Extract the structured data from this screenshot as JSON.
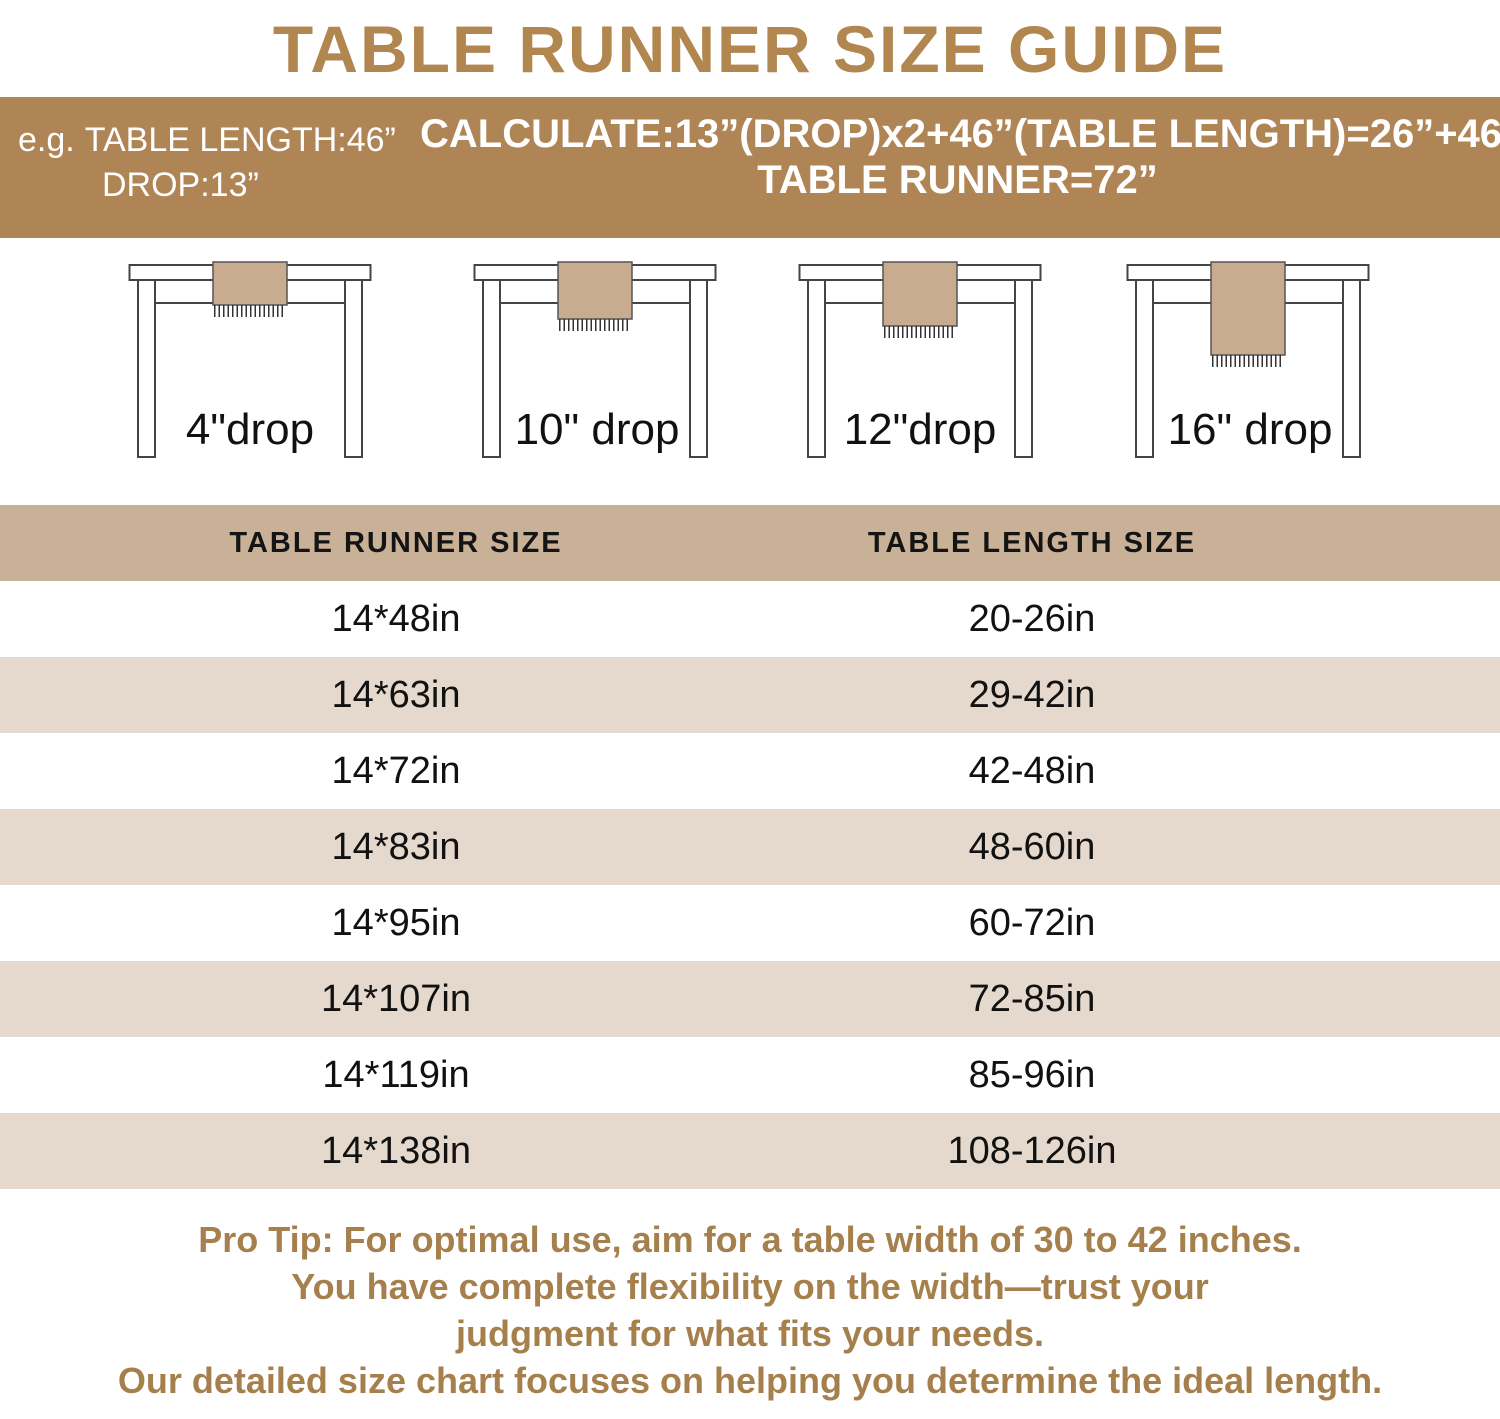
{
  "title": "TABLE RUNNER SIZE GUIDE",
  "banner": {
    "example_prefix": "e.g.",
    "example_line1": "TABLE LENGTH:46”",
    "example_line2": "DROP:13”",
    "calc_line1": "CALCULATE:13”(DROP)x2+46”(TABLE LENGTH)=26”+46”",
    "calc_line2": "TABLE RUNNER=72”"
  },
  "diagrams": [
    {
      "label": "4\"drop"
    },
    {
      "label": "10\" drop"
    },
    {
      "label": "12\"drop"
    },
    {
      "label": "16\" drop"
    }
  ],
  "size_table": {
    "headers": [
      "TABLE RUNNER SIZE",
      "TABLE LENGTH SIZE"
    ],
    "rows": [
      {
        "runner": "14*48in",
        "length": "20-26in"
      },
      {
        "runner": "14*63in",
        "length": "29-42in"
      },
      {
        "runner": "14*72in",
        "length": "42-48in"
      },
      {
        "runner": "14*83in",
        "length": "48-60in"
      },
      {
        "runner": "14*95in",
        "length": "60-72in"
      },
      {
        "runner": "14*107in",
        "length": "72-85in"
      },
      {
        "runner": "14*119in",
        "length": "85-96in"
      },
      {
        "runner": "14*138in",
        "length": "108-126in"
      }
    ]
  },
  "pro_tip": {
    "line1": "Pro Tip: For optimal use, aim for a table width of 30 to 42 inches.",
    "line2": "You have complete flexibility on the width—trust your",
    "line3": "judgment for what fits your needs.",
    "line4": "Our detailed size chart focuses on helping you determine the ideal length."
  },
  "colors": {
    "title_brown": "#b1864f",
    "banner_bg": "#b08556",
    "banner_text": "#ffffff",
    "header_band_bg": "#c9b197",
    "alt_row_bg": "#e4d9cc",
    "pro_tip_brown": "#a6804c",
    "runner_fill": "#c9ac8f",
    "diagram_line": "#444444",
    "body_text": "#111111"
  }
}
